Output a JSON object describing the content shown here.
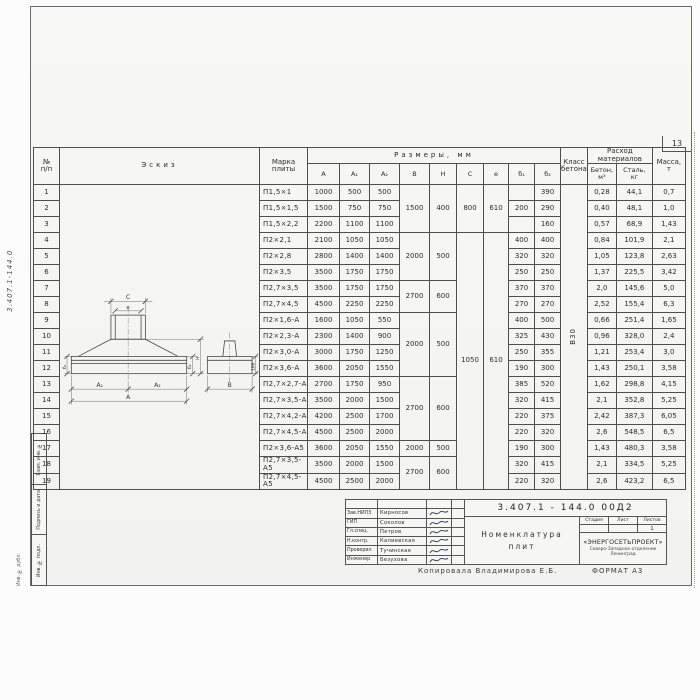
{
  "page": {
    "number": "13",
    "margin_code": "3.407.1-144.0",
    "side_stamps": [
      "Взам. инв. №",
      "Подпись и дата",
      "Инв. № подл."
    ],
    "outer_stamp": "Инв. № дубл.",
    "copied_by": "Копировала Владимирова Е.Б.",
    "format": "ФОРМАТ А3"
  },
  "table": {
    "headers": {
      "num": "№\nп/п",
      "sketch": "Эскиз",
      "mark": "Марка\nплиты",
      "dims": "Размеры, мм",
      "concrete_class": "Класс\nбетона",
      "consumption": "Расход\nматериалов",
      "concrete": "Бетон,\nм³",
      "steel": "Сталь,\nкг",
      "mass": "Масса,\nт"
    },
    "col_labels": [
      "А",
      "А₁",
      "А₂",
      "В",
      "Н",
      "С",
      "е",
      "б₁",
      "б₂"
    ],
    "rows": [
      [
        "1",
        "П1,5×1",
        "1000",
        "500",
        "500",
        {
          "t": "1500",
          "rs": 3
        },
        {
          "t": "400",
          "rs": 3
        },
        {
          "t": "800",
          "rs": 3
        },
        {
          "t": "610",
          "rs": 3
        },
        "",
        "390",
        {
          "t": "В30",
          "rs": 19,
          "cls": "rot"
        },
        "0,28",
        "44,1",
        "0,7"
      ],
      [
        "2",
        "П1,5×1,5",
        "1500",
        "750",
        "750",
        null,
        null,
        null,
        null,
        "200",
        "290",
        null,
        "0,40",
        "48,1",
        "1,0"
      ],
      [
        "3",
        "П1,5×2,2",
        "2200",
        "1100",
        "1100",
        null,
        null,
        null,
        null,
        "",
        "160",
        null,
        "0,57",
        "68,9",
        "1,43"
      ],
      [
        "4",
        "П2×2,1",
        "2100",
        "1050",
        "1050",
        {
          "t": "2000",
          "rs": 3
        },
        {
          "t": "500",
          "rs": 3
        },
        {
          "t": "1050",
          "rs": 16
        },
        {
          "t": "610",
          "rs": 16
        },
        "400",
        "400",
        null,
        "0,84",
        "101,9",
        "2,1"
      ],
      [
        "5",
        "П2×2,8",
        "2800",
        "1400",
        "1400",
        null,
        null,
        null,
        null,
        "320",
        "320",
        null,
        "1,05",
        "123,8",
        "2,63"
      ],
      [
        "6",
        "П2×3,5",
        "3500",
        "1750",
        "1750",
        null,
        null,
        null,
        null,
        "250",
        "250",
        null,
        "1,37",
        "225,5",
        "3,42"
      ],
      [
        "7",
        "П2,7×3,5",
        "3500",
        "1750",
        "1750",
        {
          "t": "2700",
          "rs": 2
        },
        {
          "t": "600",
          "rs": 2
        },
        null,
        null,
        "370",
        "370",
        null,
        "2,0",
        "145,6",
        "5,0"
      ],
      [
        "8",
        "П2,7×4,5",
        "4500",
        "2250",
        "2250",
        null,
        null,
        null,
        null,
        "270",
        "270",
        null,
        "2,52",
        "155,4",
        "6,3"
      ],
      [
        "9",
        "П2×1,6-А",
        "1600",
        "1050",
        "550",
        {
          "t": "2000",
          "rs": 4
        },
        {
          "t": "500",
          "rs": 4
        },
        null,
        null,
        "400",
        "500",
        null,
        "0,66",
        "251,4",
        "1,65"
      ],
      [
        "10",
        "П2×2,3-А",
        "2300",
        "1400",
        "900",
        null,
        null,
        null,
        null,
        "325",
        "430",
        null,
        "0,96",
        "328,0",
        "2,4"
      ],
      [
        "11",
        "П2×3,0-А",
        "3000",
        "1750",
        "1250",
        null,
        null,
        null,
        null,
        "250",
        "355",
        null,
        "1,21",
        "253,4",
        "3,0"
      ],
      [
        "12",
        "П2×3,6-А",
        "3600",
        "2050",
        "1550",
        null,
        null,
        null,
        null,
        "190",
        "300",
        null,
        "1,43",
        "250,1",
        "3,58"
      ],
      [
        "13",
        "П2,7×2,7-А",
        "2700",
        "1750",
        "950",
        {
          "t": "2700",
          "rs": 4
        },
        {
          "t": "600",
          "rs": 4
        },
        null,
        null,
        "385",
        "520",
        null,
        "1,62",
        "298,8",
        "4,15"
      ],
      [
        "14",
        "П2,7×3,5-А",
        "3500",
        "2000",
        "1500",
        null,
        null,
        null,
        null,
        "320",
        "415",
        null,
        "2,1",
        "352,8",
        "5,25"
      ],
      [
        "15",
        "П2,7×4,2-А",
        "4200",
        "2500",
        "1700",
        null,
        null,
        null,
        null,
        "220",
        "375",
        null,
        "2,42",
        "387,3",
        "6,05"
      ],
      [
        "16",
        "П2,7×4,5-А",
        "4500",
        "2500",
        "2000",
        null,
        null,
        null,
        null,
        "220",
        "320",
        null,
        "2,6",
        "548,5",
        "6,5"
      ],
      [
        "17",
        "П2×3,6-А5",
        "3600",
        "2050",
        "1550",
        "2000",
        "500",
        null,
        null,
        "190",
        "300",
        null,
        "1,43",
        "480,3",
        "3,58"
      ],
      [
        "18",
        "П2,7×3,5-А5",
        "3500",
        "2000",
        "1500",
        {
          "t": "2700",
          "rs": 2
        },
        {
          "t": "600",
          "rs": 2
        },
        null,
        null,
        "320",
        "415",
        null,
        "2,1",
        "334,5",
        "5,25"
      ],
      [
        "19",
        "П2,7×4,5-А5",
        "4500",
        "2500",
        "2000",
        null,
        null,
        null,
        null,
        "220",
        "320",
        null,
        "2,6",
        "423,2",
        "6,5"
      ]
    ]
  },
  "sketch": {
    "labels": {
      "c": "С",
      "e": "е",
      "a1": "А₁",
      "a2": "А₂",
      "a": "А",
      "b": "В",
      "b1": "б₁",
      "b2": "б₂",
      "h": "Н",
      "hundred": "100"
    }
  },
  "title_block": {
    "doc_number": "3.407.1 - 144.0  00Д2",
    "title": "Номенклатура\nплит",
    "stage_label": "Стадия",
    "sheet_label": "Лист",
    "sheets_label": "Листов",
    "sheets_value": "1",
    "org_name": "«ЭНЕРГОСЕТЬПРОЕКТ»",
    "org_branch": "Северо-Западное отделение",
    "org_city": "Ленинград",
    "signers": [
      {
        "role": "Зав.НИЛЗ",
        "name": "Кирносов"
      },
      {
        "role": "ГИП",
        "name": "Соколов"
      },
      {
        "role": "Гл.спец.",
        "name": "Петров"
      },
      {
        "role": "Н.контр.",
        "name": "Калиевская"
      },
      {
        "role": "Проверил",
        "name": "Тучинская"
      },
      {
        "role": "Инженер",
        "name": "Безухова"
      }
    ]
  }
}
